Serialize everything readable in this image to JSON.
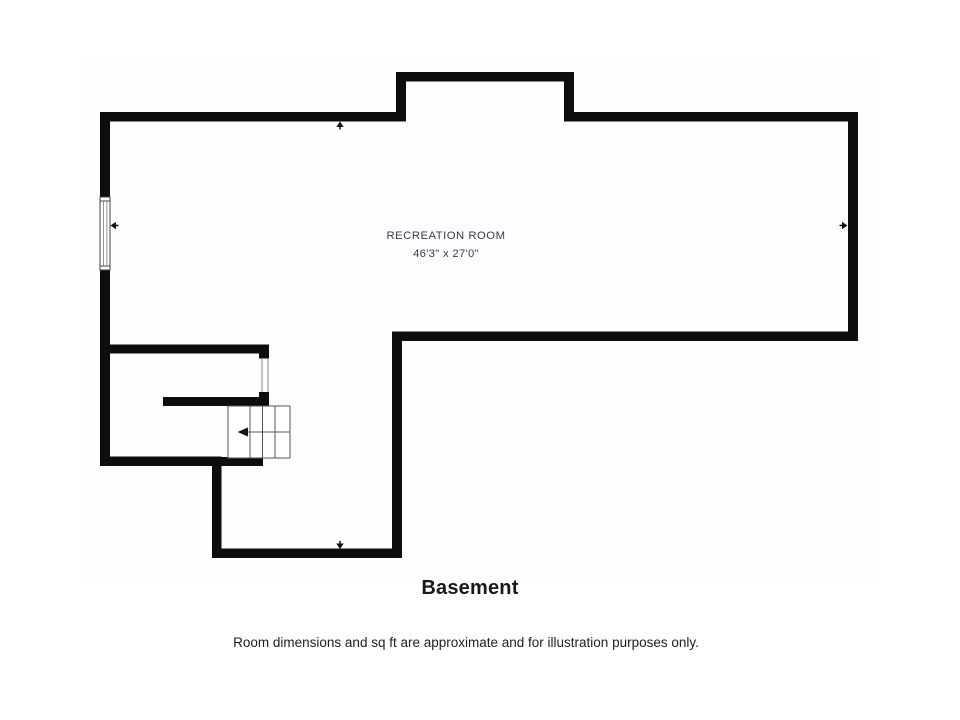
{
  "plan": {
    "room": {
      "label": "RECREATION ROOM",
      "dimensions": "46'3\" x 27'0\""
    },
    "features": {
      "stairs": "staircase with down direction arrow pointing left",
      "window": "window on left exterior wall",
      "door_opening": "interior door opening between stair landing and lower-left room"
    },
    "markers": [
      {
        "name": "up-arrow-icon",
        "location": "inside top exterior wall"
      },
      {
        "name": "left-arrow-icon",
        "location": "at left wall window"
      },
      {
        "name": "right-arrow-icon",
        "location": "inside right exterior wall"
      },
      {
        "name": "down-arrow-icon",
        "location": "inside bottom extension wall"
      }
    ],
    "colors": {
      "wall": "#0d0d0d",
      "label_text": "#3a3e44",
      "thin_line": "#555555",
      "jamb_line": "#888888",
      "canvas_bg": "#fbfdfe",
      "marker": "#111111"
    }
  },
  "footer": {
    "title": "Basement",
    "disclaimer": "Room dimensions and sq ft are approximate and for illustration purposes only."
  }
}
